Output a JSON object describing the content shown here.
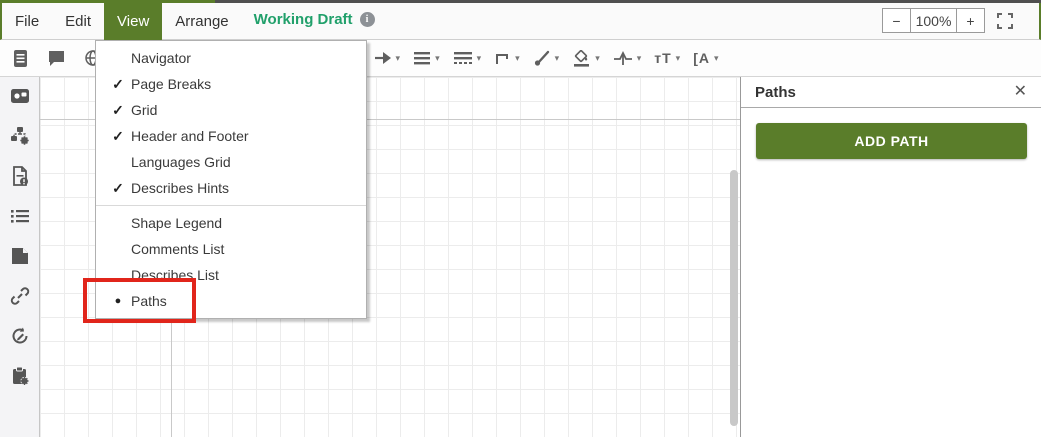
{
  "menubar": {
    "items": [
      {
        "label": "File",
        "active": false
      },
      {
        "label": "Edit",
        "active": false
      },
      {
        "label": "View",
        "active": true
      },
      {
        "label": "Arrange",
        "active": false
      }
    ],
    "draft_label": "Working Draft",
    "info_glyph": "i",
    "zoom": {
      "out": "−",
      "level": "100%",
      "in": "+"
    }
  },
  "toolbar": {
    "caret": "▾",
    "text_size_glyph": "тT",
    "font_glyph": "[A",
    "left_icons": [
      "document-icon",
      "comment-icon",
      "globe-icon"
    ],
    "right_icons": [
      "arrow-connector-icon",
      "line-style-icon",
      "line-dash-icon",
      "elbow-connector-icon",
      "brush-icon",
      "fill-color-icon",
      "waypoint-icon",
      "text-size-icon",
      "font-icon"
    ]
  },
  "view_menu": {
    "items": [
      {
        "mark": "",
        "label": "Navigator"
      },
      {
        "mark": "✓",
        "label": "Page Breaks"
      },
      {
        "mark": "✓",
        "label": "Grid"
      },
      {
        "mark": "✓",
        "label": "Header and Footer"
      },
      {
        "mark": "",
        "label": "Languages Grid"
      },
      {
        "mark": "✓",
        "label": "Describes Hints"
      },
      {
        "mark": "",
        "label": "Shape Legend"
      },
      {
        "mark": "",
        "label": "Comments List"
      },
      {
        "mark": "",
        "label": "Describes List"
      },
      {
        "mark": "●",
        "label": "Paths"
      }
    ]
  },
  "sidebar": {
    "icons": [
      "media-icon",
      "flow-settings-icon",
      "document-info-icon",
      "list-icon",
      "note-icon",
      "link-icon",
      "history-edit-icon",
      "clipboard-settings-icon"
    ]
  },
  "panel": {
    "title": "Paths",
    "close_glyph": "✕",
    "add_button_label": "ADD PATH"
  },
  "colors": {
    "accent_green": "#5a7d2a",
    "draft_green": "#21a06b",
    "annotation_red": "#e1251b"
  }
}
